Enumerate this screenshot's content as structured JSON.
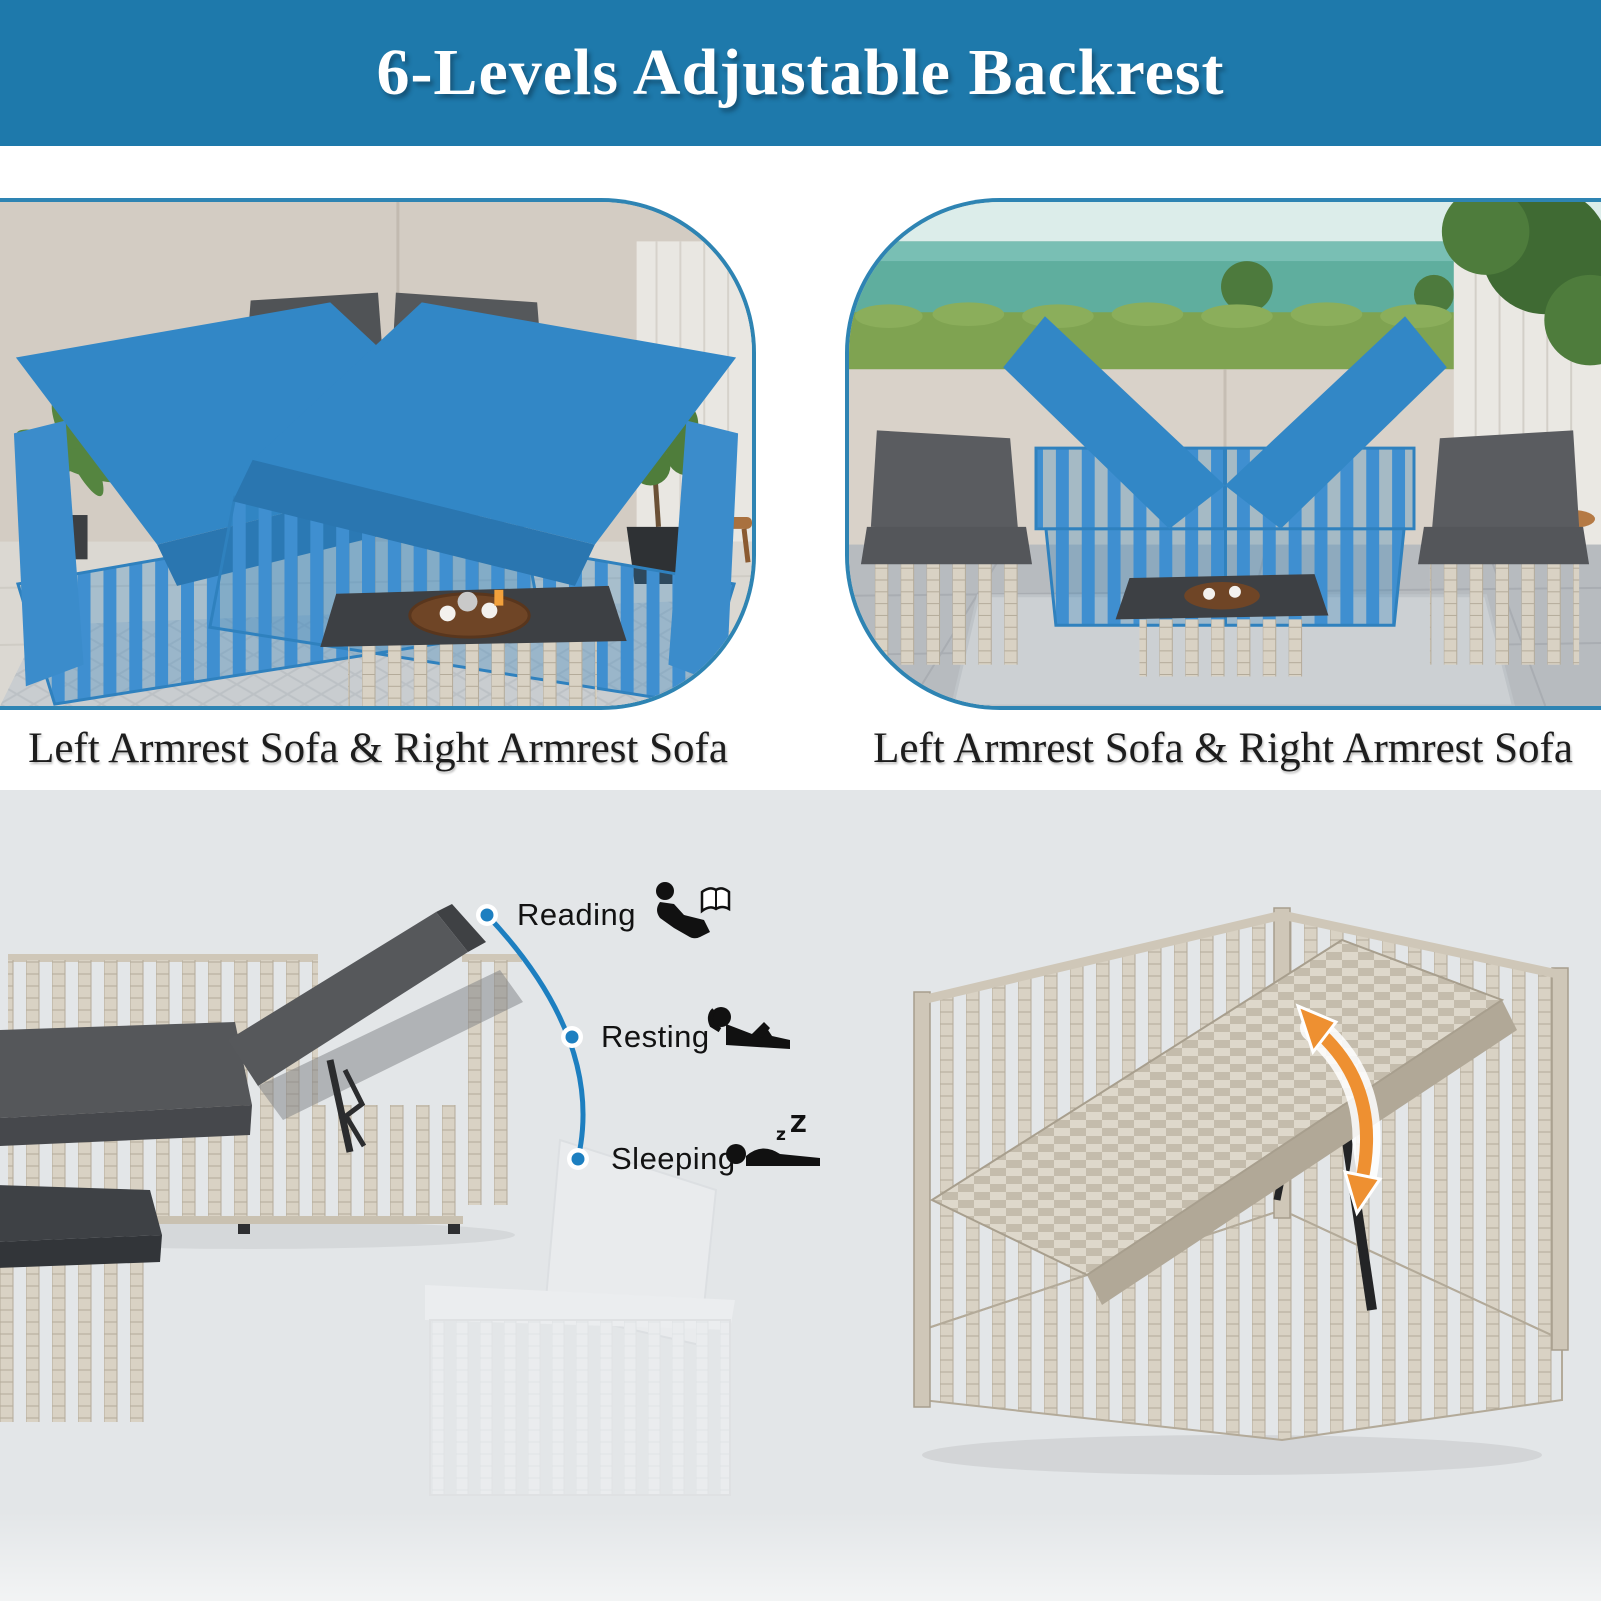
{
  "header": {
    "title": "6-Levels Adjustable Backrest"
  },
  "panels": {
    "left_photo": {
      "caption": "Left Armrest Sofa & Right Armrest Sofa",
      "scene": "patio-with-two-blue-highlighted-chaise-sofas-and-gray-loveseat"
    },
    "right_photo": {
      "caption": "Left Armrest Sofa & Right Armrest Sofa",
      "scene": "ocean-view-patio-with-blue-highlighted-sofa-frames-and-two-gray-armchairs"
    }
  },
  "backrest_levels": {
    "items": [
      {
        "label": "Reading",
        "icon": "person-reading-icon"
      },
      {
        "label": "Resting",
        "icon": "person-resting-icon"
      },
      {
        "label": "Sleeping",
        "icon": "person-sleeping-icon"
      }
    ]
  },
  "colors": {
    "banner_blue": "#1e79ab",
    "photo_border_blue": "#2e84b3",
    "highlight_blue": "#2f81be",
    "accent_blue": "#1d7fc0",
    "arrow_orange": "#ee9031",
    "panel_gray": "#e3e6e8",
    "cushion_dark": "#55575a",
    "wicker_light": "#d9d2c4",
    "text_dark": "#1d1d1d"
  }
}
